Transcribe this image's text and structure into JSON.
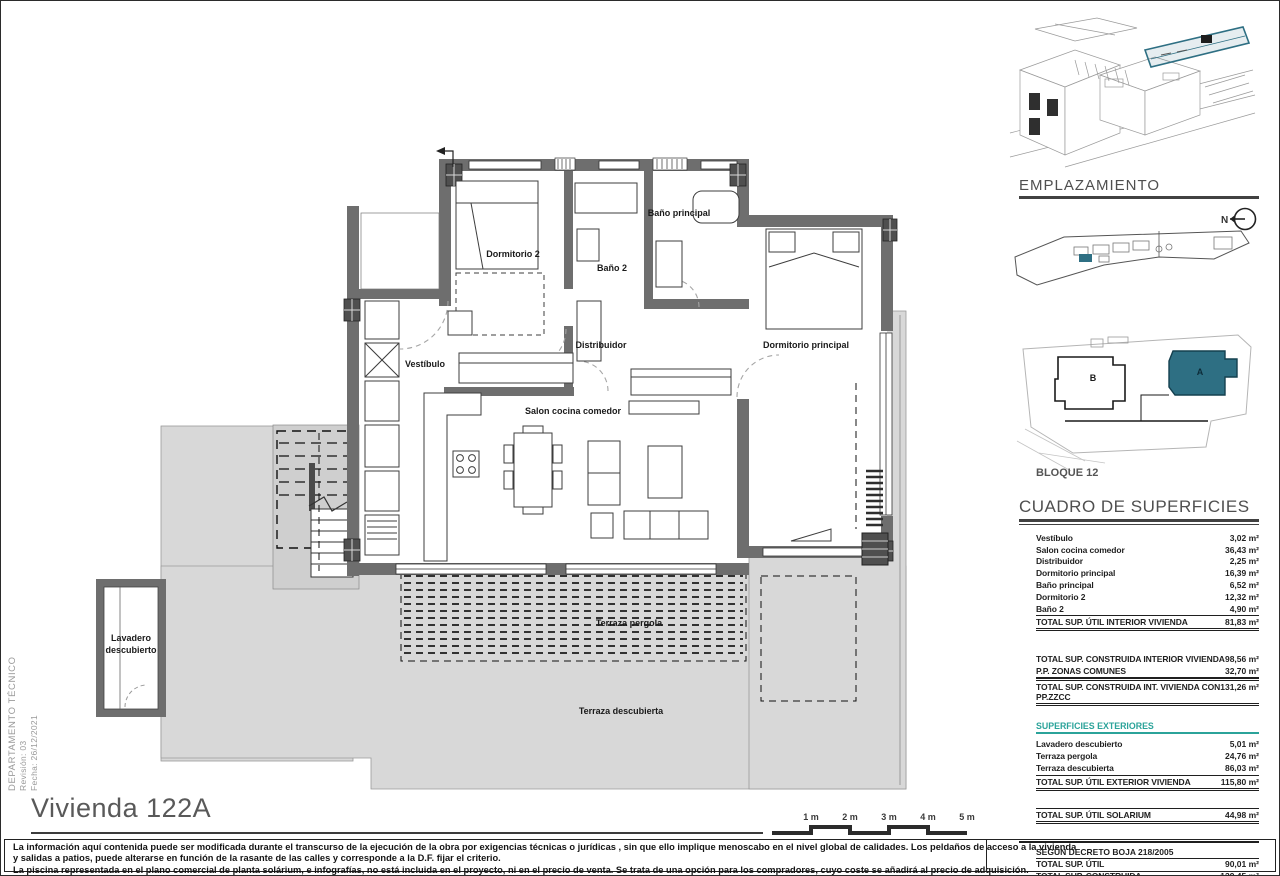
{
  "side_note": {
    "line1": "DEPARTAMENTO TÉCNICO",
    "line2": "Revisión: 03",
    "line3": "Fecha: 26/12/2021"
  },
  "plan": {
    "labels": {
      "dormitorio2": "Dormitorio 2",
      "bano2": "Baño 2",
      "bano_principal": "Baño principal",
      "dormitorio_principal": "Dormitorio principal",
      "vestibulo": "Vestíbulo",
      "distribuidor": "Distribuidor",
      "salon": "Salon cocina comedor",
      "terraza_pergola": "Terraza pergola",
      "terraza_descubierta": "Terraza descubierta",
      "lavadero_line1": "Lavadero",
      "lavadero_line2": "descubierto"
    }
  },
  "sidebar": {
    "emplazamiento_title": "EMPLAZAMIENTO",
    "north_label": "N",
    "block_a_label": "A",
    "block_b_label": "B",
    "bloque_label": "BLOQUE 12",
    "surfaces": {
      "title": "CUADRO DE SUPERFICIES",
      "interior_rows": [
        {
          "label": "Vestíbulo",
          "value": "3,02 m²"
        },
        {
          "label": "Salon cocina comedor",
          "value": "36,43 m²"
        },
        {
          "label": "Distribuidor",
          "value": "2,25 m²"
        },
        {
          "label": "Dormitorio principal",
          "value": "16,39 m²"
        },
        {
          "label": "Baño principal",
          "value": "6,52 m²"
        },
        {
          "label": "Dormitorio 2",
          "value": "12,32 m²"
        },
        {
          "label": "Baño 2",
          "value": "4,90 m²"
        }
      ],
      "interior_total": {
        "label": "TOTAL SUP. ÚTIL INTERIOR VIVIENDA",
        "value": "81,83 m²"
      },
      "construida_rows": [
        {
          "label": "TOTAL SUP. CONSTRUIDA INTERIOR VIVIENDA",
          "value": "98,56 m²"
        },
        {
          "label": "P.P. ZONAS COMUNES",
          "value": "32,70 m²"
        }
      ],
      "construida_total": {
        "label": "TOTAL SUP. CONSTRUIDA INT. VIVIENDA CON PP.ZZCC",
        "value": "131,26 m²"
      },
      "exteriores_title": "SUPERFICIES EXTERIORES",
      "exterior_rows": [
        {
          "label": "Lavadero descubierto",
          "value": "5,01 m²"
        },
        {
          "label": "Terraza pergola",
          "value": "24,76 m²"
        },
        {
          "label": "Terraza descubierta",
          "value": "86,03 m²"
        }
      ],
      "exterior_total": {
        "label": "TOTAL SUP. ÚTIL EXTERIOR VIVIENDA",
        "value": "115,80 m²"
      },
      "solarium_total": {
        "label": "TOTAL SUP. ÚTIL SOLARIUM",
        "value": "44,98 m²"
      },
      "decreto_title": "SEGÚN DECRETO BOJA 218/2005",
      "decreto_rows": [
        {
          "label": "TOTAL SUP. ÚTIL",
          "value": "90,01 m²"
        },
        {
          "label": "TOTAL SUP. CONSTRUIDA",
          "value": "139,45 m²"
        }
      ]
    }
  },
  "footer": {
    "title": "Vivienda 122A",
    "scale_labels": [
      "1 m",
      "2 m",
      "3 m",
      "4 m",
      "5 m"
    ],
    "disclaimer_lines": [
      "La información aquí contenida puede ser modificada durante el transcurso de la ejecución de la obra por exigencias técnicas o jurídicas , sin que ello implique menoscabo en el nivel global de calidades. Los peldaños de acceso a la vivienda",
      "y salidas a patios, puede alterarse en función de la rasante de las calles y corresponde a  la D.F. fijar el criterio.",
      "La piscina representada en el plano comercial de planta solárium, e infografías, no está incluida en el proyecto, ni en el precio de venta. Se trata de una opción para los compradores, cuyo coste se añadirá al precio de adquisición."
    ]
  },
  "colors": {
    "accent_teal": "#2e6f83",
    "superficies_header_teal": "#2ba39a",
    "wall_gray": "#6e6e6e",
    "terrace_gray": "#d8d8d8"
  }
}
